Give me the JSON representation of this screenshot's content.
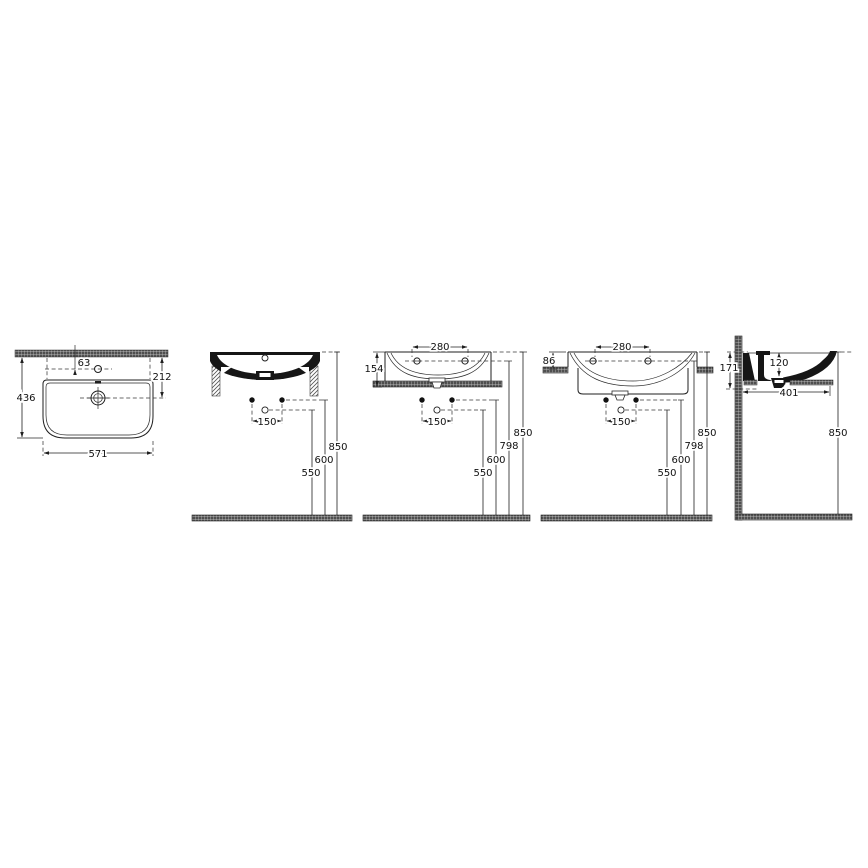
{
  "drawing": {
    "colors": {
      "line": "#1f1f1f",
      "hatch_dark": "#565656",
      "background": "#ffffff"
    },
    "views": {
      "plan": {
        "dim_faucet_offset": "63",
        "dim_drain_offset": "212",
        "dim_depth": "436",
        "dim_width": "571"
      },
      "wall_hung": {
        "dim_hole_spacing": "150",
        "dim_siphon_height": "550",
        "dim_fixing_height": "600",
        "dim_rim_height": "850"
      },
      "counter_top": {
        "dim_tap_spacing": "280",
        "dim_body_height": "154",
        "dim_hole_spacing": "150",
        "dim_siphon_height": "550",
        "dim_fixing_height": "600",
        "dim_counter_height": "798",
        "dim_rim_height": "850"
      },
      "semi_recessed": {
        "dim_tap_spacing": "280",
        "dim_above_counter": "86",
        "dim_hole_spacing": "150",
        "dim_siphon_height": "550",
        "dim_fixing_height": "600",
        "dim_counter_height": "798",
        "dim_rim_height": "850"
      },
      "side_section": {
        "dim_bowl_depth": "120",
        "dim_body_height": "171",
        "dim_projection": "401",
        "dim_rim_height": "850"
      }
    }
  }
}
